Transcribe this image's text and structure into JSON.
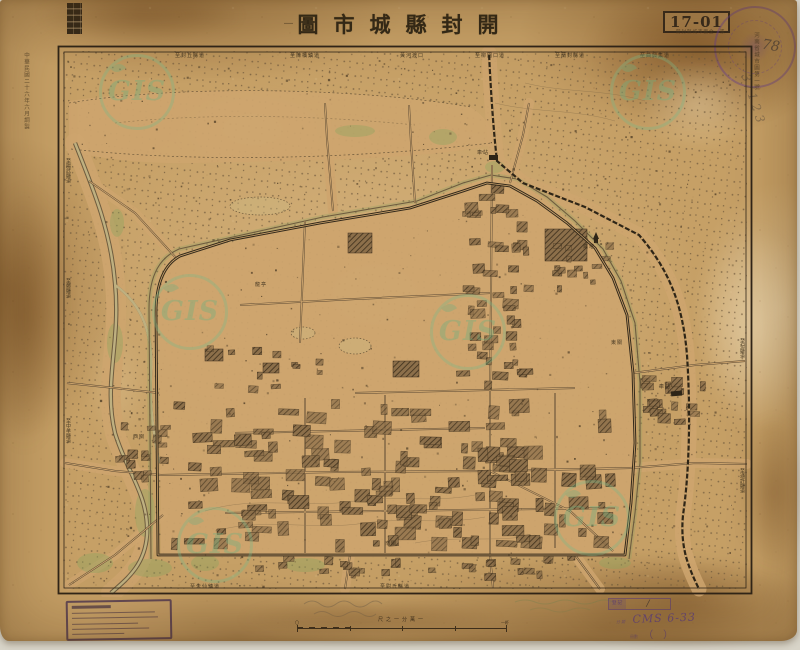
{
  "header": {
    "title_display": "圖市城縣封開",
    "title_dash": "—",
    "plate_number": "17-01",
    "subtitle_small": "開封縣城市圖全一張"
  },
  "margins": {
    "left_vertical": "中華民國二十六年六月調製",
    "right_vertical": "河南省城市圖第一號",
    "pencil_number": "78",
    "pencil_scrawl": "3/123"
  },
  "scale": {
    "caption": "尺之一分萬一",
    "left_label": "〇",
    "right_label": "一粁"
  },
  "stamps": {
    "catalog_rows": [
      {
        "label": "登記",
        "value": "∕"
      },
      {
        "label": "分類",
        "value": "CMS 6-33"
      },
      {
        "label": "冊數",
        "value": "（　）"
      }
    ]
  },
  "watermark": {
    "text": "GIS"
  },
  "colors": {
    "paper": "#c6a066",
    "ink": "#342a1b",
    "stamp_purple": "#6b4a8a",
    "watermark_green": "#7ab98a",
    "vegetation": "#8fae6a"
  },
  "map": {
    "labels": [
      {
        "text": "至封丘縣道",
        "x": 120,
        "y": 9
      },
      {
        "text": "至陳橋鎮道",
        "x": 235,
        "y": 9
      },
      {
        "text": "黃河渡口",
        "x": 345,
        "y": 9
      },
      {
        "text": "至柳園口道",
        "x": 420,
        "y": 9
      },
      {
        "text": "至蘭封縣道",
        "x": 500,
        "y": 9
      },
      {
        "text": "至曲興集道",
        "x": 585,
        "y": 9
      },
      {
        "text": "至陽武縣道",
        "x": 10,
        "y": 115,
        "v": 1
      },
      {
        "text": "至鄭縣道",
        "x": 10,
        "y": 235,
        "v": 1
      },
      {
        "text": "至中牟縣道",
        "x": 10,
        "y": 375,
        "v": 1
      },
      {
        "text": "至杞縣道",
        "x": 684,
        "y": 295,
        "v": 1
      },
      {
        "text": "至通許縣道",
        "x": 684,
        "y": 425,
        "v": 1
      },
      {
        "text": "至朱仙鎮道",
        "x": 135,
        "y": 540
      },
      {
        "text": "至尉氏縣道",
        "x": 325,
        "y": 540
      },
      {
        "text": "龍亭",
        "x": 200,
        "y": 238
      },
      {
        "text": "鐵塔",
        "x": 528,
        "y": 200
      },
      {
        "text": "車站",
        "x": 422,
        "y": 106
      },
      {
        "text": "車站",
        "x": 604,
        "y": 340
      },
      {
        "text": "西關",
        "x": 78,
        "y": 390
      },
      {
        "text": "南關",
        "x": 330,
        "y": 497
      },
      {
        "text": "東關",
        "x": 556,
        "y": 296
      }
    ]
  }
}
